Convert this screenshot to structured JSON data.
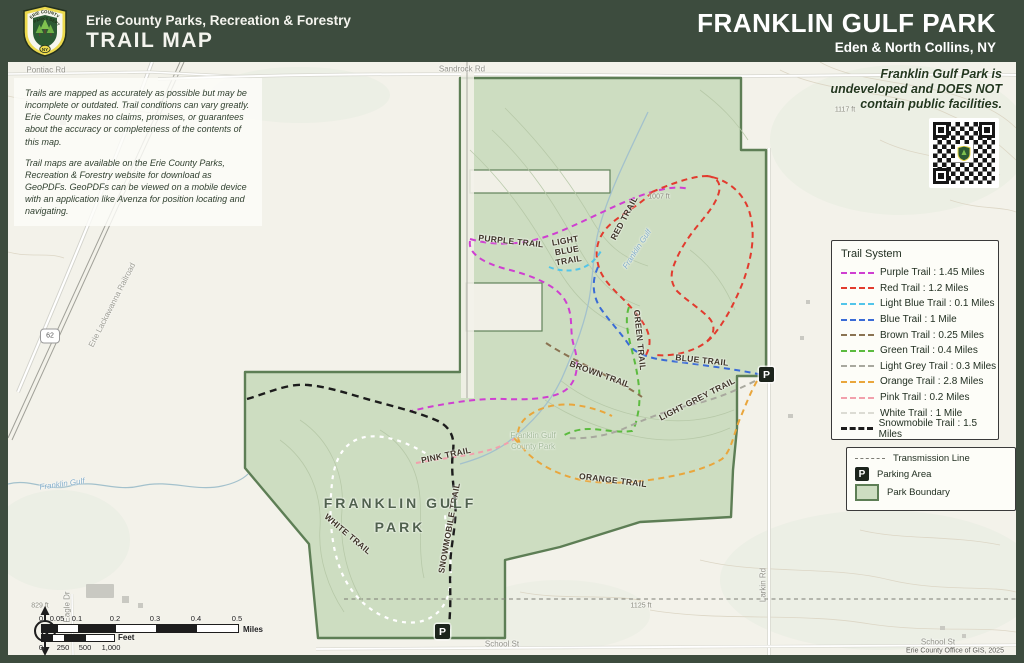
{
  "header": {
    "org": "Erie County Parks, Recreation & Forestry",
    "doc_type": "TRAIL MAP",
    "park_name": "FRANKLIN GULF PARK",
    "location": "Eden & North Collins, NY",
    "logo": {
      "line1": "ERIE COUNTY",
      "line2": "PARKS DEPT",
      "state": "NY"
    }
  },
  "notices": {
    "disclaimer_p1": "Trails are mapped as accurately as possible but may be incomplete or outdated. Trail conditions can vary greatly. Erie County makes no claims, promises, or guarantees about the accuracy or completeness of the contents of this map.",
    "disclaimer_p2": "Trail maps are available on the Erie County Parks, Recreation & Forestry website for download as GeoPDFs. GeoPDFs can be viewed on a mobile device with an application like Avenza for position locating and navigating.",
    "undeveloped": "Franklin Gulf Park is undeveloped and DOES NOT contain public facilities."
  },
  "legend": {
    "title": "Trail System",
    "trails": [
      {
        "name": "Purple Trail",
        "length": "1.45 Miles",
        "color": "#cf3fd1",
        "label": "Purple Trail : 1.45 Miles"
      },
      {
        "name": "Red Trail",
        "length": "1.2 Miles",
        "color": "#e23b2e",
        "label": "Red Trail : 1.2 Miles"
      },
      {
        "name": "Light Blue Trail",
        "length": "0.1 Miles",
        "color": "#52c5ea",
        "label": "Light Blue Trail : 0.1 Miles"
      },
      {
        "name": "Blue Trail",
        "length": "1 Mile",
        "color": "#3a6bd6",
        "label": "Blue Trail : 1 Mile"
      },
      {
        "name": "Brown Trail",
        "length": "0.25 Miles",
        "color": "#8a7352",
        "label": "Brown Trail : 0.25 Miles"
      },
      {
        "name": "Green Trail",
        "length": "0.4 Miles",
        "color": "#5cbb3f",
        "label": "Green Trail : 0.4 Miles"
      },
      {
        "name": "Light Grey Trail",
        "length": "0.3 Miles",
        "color": "#a8a89e",
        "label": "Light Grey Trail : 0.3 Miles"
      },
      {
        "name": "Orange Trail",
        "length": "2.8 Miles",
        "color": "#e9a63c",
        "label": "Orange Trail : 2.8 Miles"
      },
      {
        "name": "Pink Trail",
        "length": "0.2 Miles",
        "color": "#f2a0ac",
        "label": "Pink Trail : 0.2 Miles"
      },
      {
        "name": "White Trail",
        "length": "1 Mile",
        "color": "#ffffff",
        "label": "White Trail : 1 Mile"
      },
      {
        "name": "Snowmobile Trail",
        "length": "1.5 Miles",
        "color": "#1c1c1c",
        "label": "Snowmobile Trail : 1.5 Miles"
      }
    ],
    "other": [
      {
        "label": "Transmission Line"
      },
      {
        "label": "Parking Area"
      },
      {
        "label": "Park Boundary"
      }
    ]
  },
  "map": {
    "park_name_label": {
      "line1": "FRANKLIN GULF",
      "line2": "PARK"
    },
    "basemap_park_label": {
      "line1": "Franklin Gulf",
      "line2": "County Park"
    },
    "trail_labels": {
      "purple": "PURPLE TRAIL",
      "light_blue": "LIGHT BLUE TRAIL",
      "red": "RED TRAIL",
      "blue": "BLUE TRAIL",
      "green": "GREEN TRAIL",
      "brown": "BROWN TRAIL",
      "light_grey": "LIGHT GREY TRAIL",
      "orange": "ORANGE TRAIL",
      "pink": "PINK TRAIL",
      "white": "WHITE TRAIL",
      "snowmobile": "SNOWMOBILE TRAIL"
    },
    "roads": {
      "pontiac": "Pontiac Rd",
      "sandrock": "Sandrock Rd",
      "larkin": "Larkin Rd",
      "school": "School St",
      "school2": "School St",
      "eagle": "Eagle Dr",
      "railroad": "Erie Lackawanna Railroad",
      "route_shield": "62"
    },
    "stream_label": "Franklin Gulf",
    "elevations": {
      "e1007": "1007 ft",
      "e1117": "1117 ft",
      "e1125": "1125 ft",
      "e829": "829 ft"
    },
    "parking_symbol": "P"
  },
  "scale": {
    "north": "N",
    "miles_ticks": [
      "0",
      "0.05",
      "0.1",
      "0.2",
      "0.3",
      "0.4",
      "0.5"
    ],
    "miles_unit": "Miles",
    "feet_ticks": [
      "0",
      "250",
      "500",
      "1,000"
    ],
    "feet_unit": "Feet"
  },
  "attribution": "Erie County Office of GIS, 2025",
  "colors": {
    "header_bg": "#3d4c3e",
    "map_bg": "#f3f2ea",
    "park_fill": "#cdddc1",
    "park_border": "#5d7e55",
    "water": "#a3c1cc",
    "contour_outside": "#dcd6c5",
    "contour_inside": "#b5c7a6"
  }
}
